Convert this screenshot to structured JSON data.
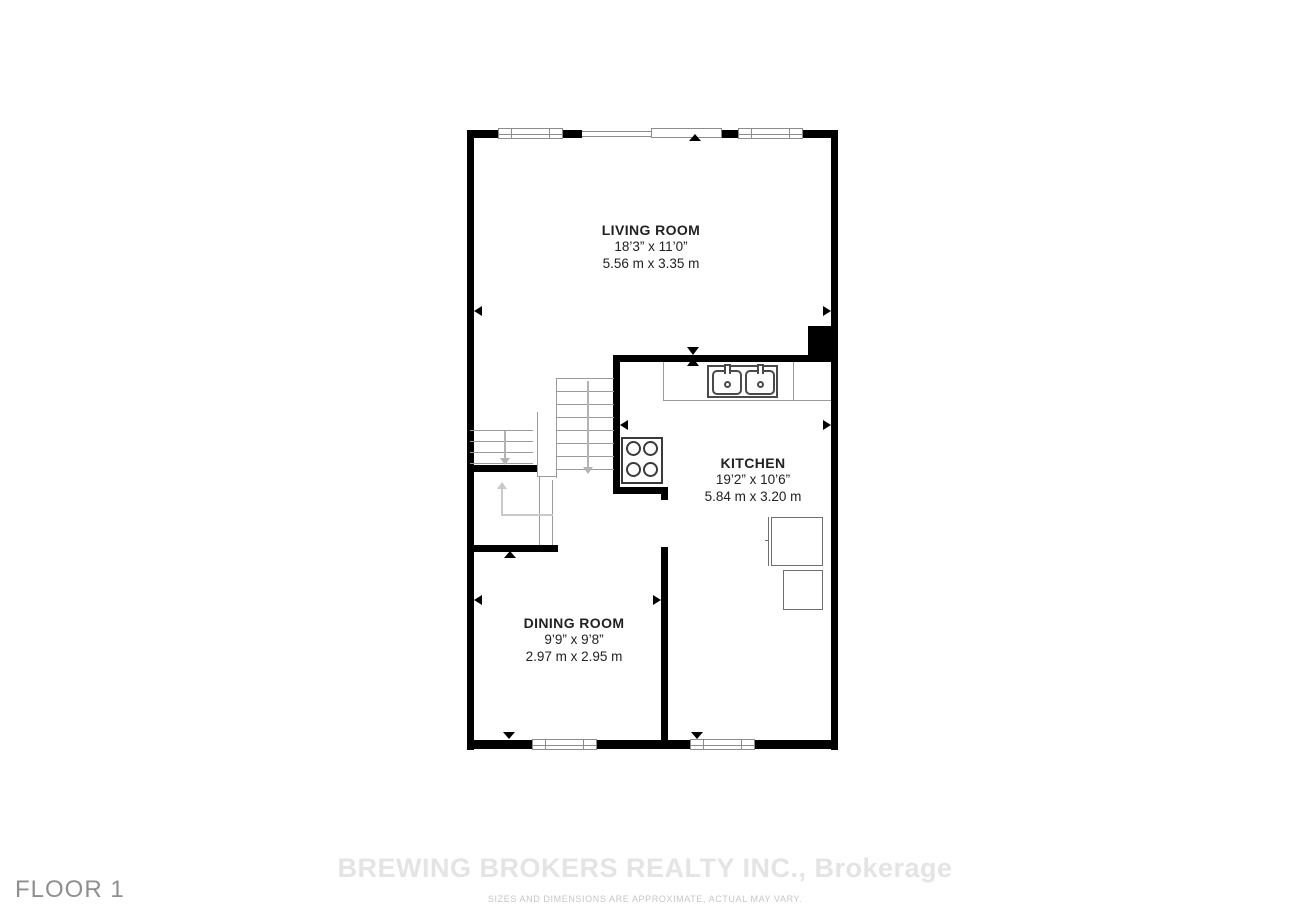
{
  "floor": {
    "label": "FLOOR 1"
  },
  "rooms": [
    {
      "name": "LIVING ROOM",
      "imperial": "18’3” x 11’0”",
      "metric": "5.56 m x 3.35 m"
    },
    {
      "name": "KITCHEN",
      "imperial": "19’2” x 10’6”",
      "metric": "5.84 m x 3.20 m"
    },
    {
      "name": "DINING ROOM",
      "imperial": "9’9” x 9’8”",
      "metric": "2.97 m x 2.95 m"
    }
  ],
  "watermark": {
    "brokerage": "BREWING BROKERS REALTY INC., Brokerage",
    "disclaimer": "SIZES AND DIMENSIONS ARE APPROXIMATE, ACTUAL MAY VARY."
  },
  "fixtures": {
    "staircase": "staircase",
    "sink": "double kitchen sink",
    "stove": "four-burner stove",
    "refrigerator": "refrigerator",
    "cabinet": "cabinet"
  },
  "colors": {
    "wall": "#000000",
    "window_frame": "#8c8c8c",
    "stair_line": "#9b9b9b",
    "arrow_gray": "#b3b3b3",
    "arrow_light": "#c9c9c9",
    "label_text": "#222222",
    "floor_label": "#8f8f8f",
    "watermark": "#e4e4e4",
    "disclaimer": "#c6c6c6",
    "background": "#ffffff"
  }
}
